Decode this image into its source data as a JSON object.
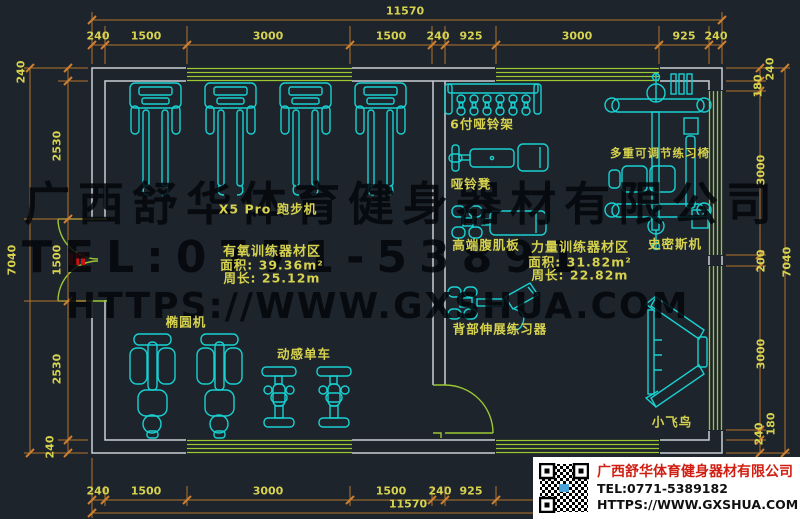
{
  "colors": {
    "background": "#1d242c",
    "wall": "#c9ced3",
    "window_door_green": "#9cc732",
    "equipment_cyan": "#19d1d1",
    "label_yellow": "#d6d24e",
    "dimension_orange": "#b5742c",
    "stamp_red": "#cc1111",
    "company_red": "#d01f12"
  },
  "watermark": {
    "line1": "广西舒华体育健身器材有限公司",
    "line2": "TEL:0771-53891",
    "line3": "HTTPS://WWW.GXSHUA.COM"
  },
  "dims": {
    "top_overall": "11570",
    "top_segments": [
      "240",
      "1500",
      "3000",
      "1500",
      "240",
      "925",
      "3000",
      "925",
      "240"
    ],
    "bottom_overall": "11570",
    "bottom_segments": [
      "240",
      "1500",
      "3000",
      "1500",
      "240",
      "925"
    ],
    "left_overall": "7040",
    "left_segments": [
      "240",
      "2530",
      "1500",
      "2530",
      "240"
    ],
    "right_overall": "7040",
    "right_segments": [
      "240",
      "180",
      "3000",
      "200",
      "3000",
      "180",
      "240"
    ]
  },
  "labels": {
    "treadmill": "X5 Pro 跑步机",
    "elliptical": "椭圆机",
    "spin_bike": "动感单车",
    "dumbbell_rack": "6付哑铃架",
    "dumbbell_bench": "哑铃凳",
    "ab_board": "高端腹肌板",
    "back_extension": "背部伸展练习器",
    "adjustable_bench": "多重可调节练习椅",
    "smith_machine": "史密斯机",
    "fly_bird": "小飞鸟"
  },
  "zones": {
    "aerobic": {
      "name": "有氧训练器材区",
      "area": "面积: 39.36m²",
      "perimeter": "周长: 25.12m"
    },
    "strength": {
      "name": "力量训练器材区",
      "area": "面积: 31.82m²",
      "perimeter": "周长: 22.82m"
    }
  },
  "info_box": {
    "company": "广西舒华体育健身器材有限公司",
    "tel": "TEL:0771-5389182",
    "website": "HTTPS://WWW.GXSHUA.COM"
  }
}
